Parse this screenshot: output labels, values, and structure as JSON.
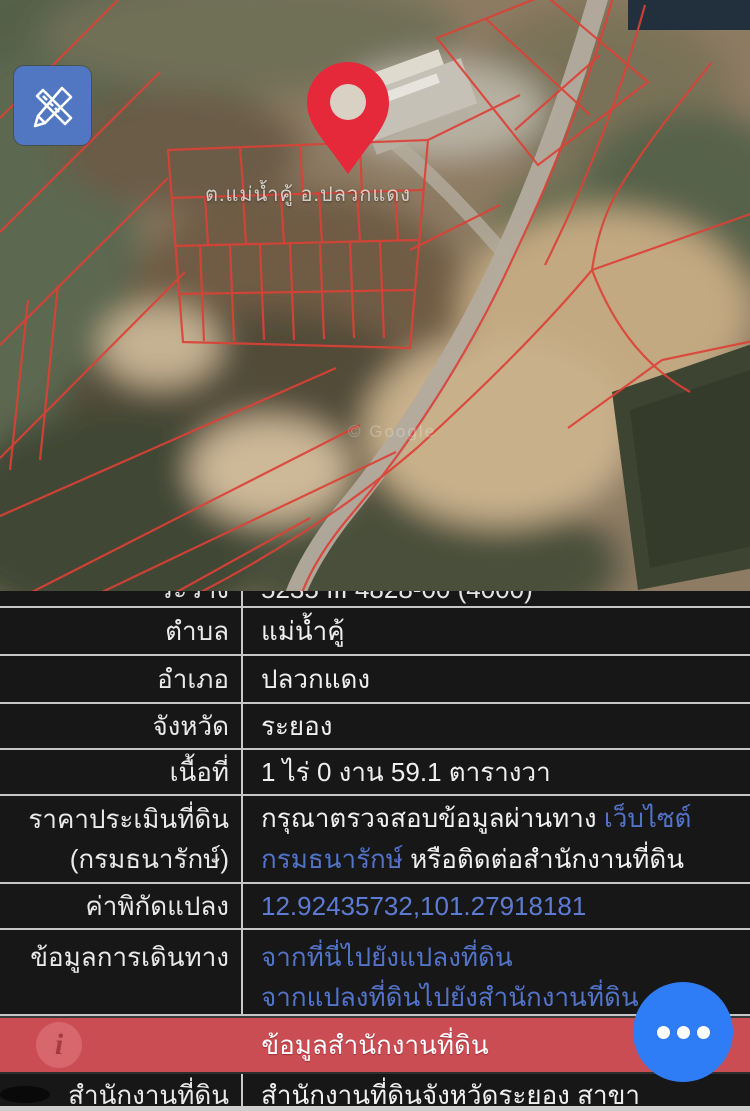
{
  "map": {
    "place_label": "ต.แม่น้ำคู้ อ.ปลวกแดง",
    "watermark": "© Google",
    "edit_button_icon": "pencil-ruler-icon",
    "colors": {
      "pin": "#e5293b",
      "edit_button": "#5177c3",
      "parcel_line": "#dd4136",
      "fab": "#2e7cf6",
      "banner": "#cb4d54",
      "link": "#5373c9"
    }
  },
  "table": {
    "clipped_row": {
      "label": "ระวาง",
      "value": "5235 III 4828-00 (4000)"
    },
    "rows": [
      {
        "label": "ตำบล",
        "value": "แม่น้ำคู้"
      },
      {
        "label": "อำเภอ",
        "value": "ปลวกแดง"
      },
      {
        "label": "จังหวัด",
        "value": "ระยอง"
      },
      {
        "label": "เนื้อที่",
        "value": "1 ไร่ 0 งาน 59.1 ตารางวา"
      }
    ],
    "price": {
      "label_line1": "ราคาประเมินที่ดิน",
      "label_line2": "(กรมธนารักษ์)",
      "l1_text": "กรุณาตรวจสอบข้อมูลผ่านทาง ",
      "l1_link": "เว็บไซต์",
      "l2_link": "กรมธนารักษ์",
      "l2_text": " หรือติดต่อสำนักงานที่ดิน"
    },
    "coord": {
      "label": "ค่าพิกัดแปลง",
      "value": "12.92435732,101.27918181"
    },
    "travel": {
      "label": "ข้อมูลการเดินทาง",
      "link1": "จากที่นี่ไปยังแปลงที่ดิน",
      "link2": "จากแปลงที่ดินไปยังสำนักงานที่ดิน"
    },
    "office": {
      "label": "สำนักงานที่ดิน",
      "value": "สำนักงานที่ดินจังหวัดระยอง สาขา"
    }
  },
  "banner": {
    "label": "ข้อมูลสำนักงานที่ดิน",
    "info_glyph": "i"
  }
}
